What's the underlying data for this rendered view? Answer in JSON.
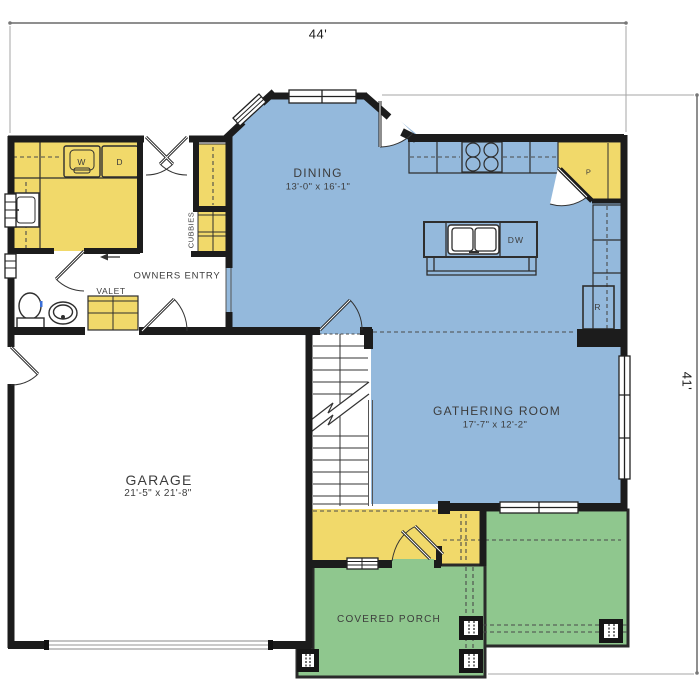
{
  "plan": {
    "dimensions": {
      "width": "44'",
      "height": "41'"
    },
    "rooms": {
      "dining": {
        "name": "DINING",
        "size": "13'-0\" x 16'-1\""
      },
      "gathering": {
        "name": "GATHERING ROOM",
        "size": "17'-7\" x 12'-2\""
      },
      "garage": {
        "name": "GARAGE",
        "size": "21'-5\" x 21'-8\""
      },
      "covered_porch": {
        "name": "COVERED PORCH"
      },
      "owners_entry": {
        "name": "OWNERS ENTRY"
      },
      "valet": {
        "name": "VALET"
      },
      "cubbies": {
        "name": "CUBBIES"
      }
    },
    "appliances": {
      "washer": "W",
      "dryer": "D",
      "dishwasher": "DW",
      "pantry": "P",
      "refrigerator": "R"
    },
    "colors": {
      "living_area": "#94b9dc",
      "cabinetry": "#f1d96a",
      "porch": "#8fc78e",
      "wall": "#1c1c1c"
    }
  }
}
